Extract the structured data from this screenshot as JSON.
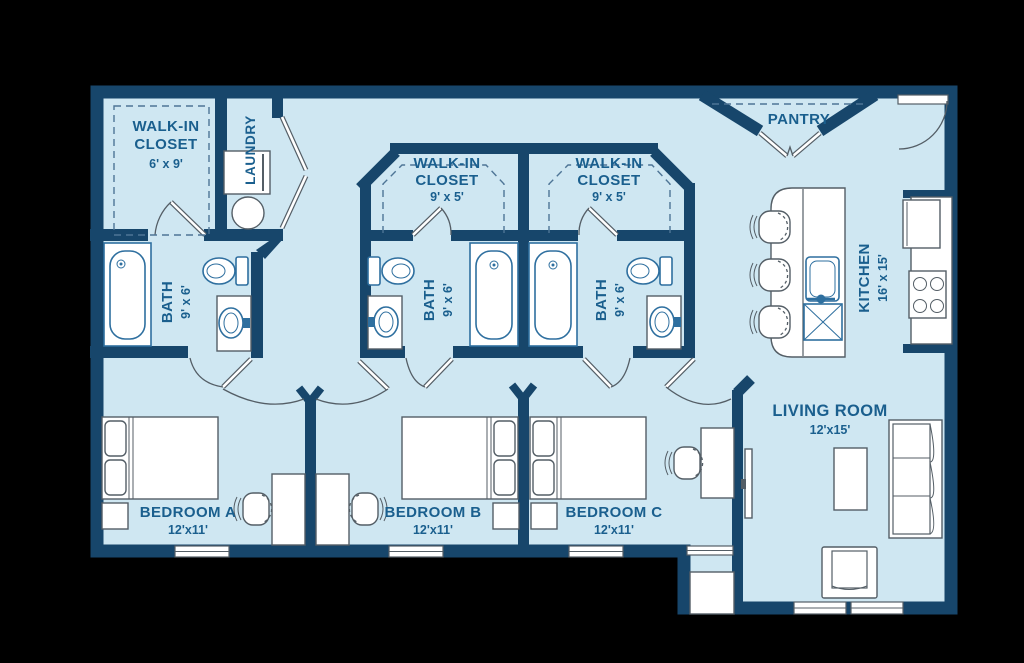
{
  "title": "3-bedroom / 3-bath apartment floor plan",
  "colors": {
    "background": "#000000",
    "floor": "#cfe7f2",
    "wall": "#17466b",
    "label_text": "#1a5f8e",
    "fixture_blue": "#2e6f9f",
    "furniture_gray": "#545e66"
  },
  "rooms": {
    "walk_in_closet_a": {
      "line1": "WALK-IN",
      "line2": "CLOSET",
      "dims": "6' x 9'"
    },
    "laundry": {
      "name": "LAUNDRY"
    },
    "walk_in_closet_b": {
      "line1": "WALK-IN",
      "line2": "CLOSET",
      "dims": "9' x 5'"
    },
    "walk_in_closet_c": {
      "line1": "WALK-IN",
      "line2": "CLOSET",
      "dims": "9' x 5'"
    },
    "bath_a": {
      "name": "BATH",
      "dims": "9' x 6'"
    },
    "bath_b": {
      "name": "BATH",
      "dims": "9' x 6'"
    },
    "bath_c": {
      "name": "BATH",
      "dims": "9' x 6'"
    },
    "pantry": {
      "name": "PANTRY"
    },
    "kitchen": {
      "name": "KITCHEN",
      "dims": "16' x 15'"
    },
    "living_room": {
      "name": "LIVING ROOM",
      "dims": "12'x15'"
    },
    "bedroom_a": {
      "name": "BEDROOM A",
      "dims": "12'x11'"
    },
    "bedroom_b": {
      "name": "BEDROOM B",
      "dims": "12'x11'"
    },
    "bedroom_c": {
      "name": "BEDROOM C",
      "dims": "12'x11'"
    }
  }
}
